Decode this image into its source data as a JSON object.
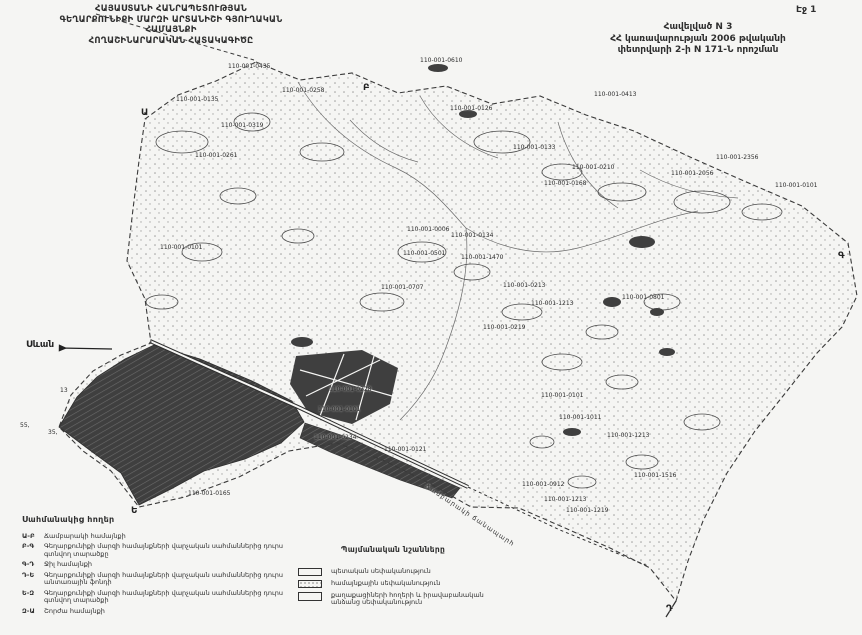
{
  "page": {
    "number_label": "Էջ 1"
  },
  "header": {
    "title_lines": [
      "ՀԱՅԱՍՏԱՆԻ ՀԱՆՐԱՊԵՏՈՒԹՅԱՆ",
      "ԳԵՂԱՐՔՈՒՆԻՔԻ ՄԱՐԶԻ ԱՐՏԱՆԻՇԻ ԳՅՈՒՂԱԿԱՆ ՀԱՄԱՅՆՔԻ",
      "ՀՈՂԱՇԻՆԱՐԱՐԱԿԱՆ ՀԱՏԱԿԱԳԻԾԸ"
    ],
    "decree_lines": [
      "Հավելված N 3",
      "ՀՀ կառավարության 2006 թվականի",
      "փետրվարի 2-ի N 171-Ն որոշման"
    ]
  },
  "map": {
    "lake_label": "Սևան",
    "road_label": "Ճամբարակի ճանապարհ",
    "boundary_letters": [
      {
        "ch": "Ա",
        "x": 141,
        "y": 109
      },
      {
        "ch": "Բ",
        "x": 363,
        "y": 84
      },
      {
        "ch": "Գ",
        "x": 838,
        "y": 252
      },
      {
        "ch": "Դ",
        "x": 666,
        "y": 605
      },
      {
        "ch": "Ե",
        "x": 131,
        "y": 507
      }
    ],
    "parcel_labels": [
      {
        "t": "110-001-0435",
        "x": 228,
        "y": 64
      },
      {
        "t": "110-001-0610",
        "x": 420,
        "y": 58
      },
      {
        "t": "110-001-0126",
        "x": 450,
        "y": 106
      },
      {
        "t": "110-001-0258",
        "x": 282,
        "y": 88
      },
      {
        "t": "110-001-0135",
        "x": 176,
        "y": 97
      },
      {
        "t": "110-001-0319",
        "x": 221,
        "y": 123
      },
      {
        "t": "110-001-0261",
        "x": 195,
        "y": 153
      },
      {
        "t": "110-001-0413",
        "x": 594,
        "y": 92
      },
      {
        "t": "110-001-0210",
        "x": 572,
        "y": 165
      },
      {
        "t": "110-001-2056",
        "x": 671,
        "y": 171
      },
      {
        "t": "110-001-2356",
        "x": 716,
        "y": 155
      },
      {
        "t": "110-001-0101",
        "x": 775,
        "y": 183
      },
      {
        "t": "110-001-0133",
        "x": 513,
        "y": 145
      },
      {
        "t": "110-001-0168",
        "x": 544,
        "y": 181
      },
      {
        "t": "110-001-0006",
        "x": 407,
        "y": 227
      },
      {
        "t": "110-001-0134",
        "x": 451,
        "y": 233
      },
      {
        "t": "110-001-0501",
        "x": 403,
        "y": 251
      },
      {
        "t": "110-001-1470",
        "x": 461,
        "y": 255
      },
      {
        "t": "110-001-0707",
        "x": 381,
        "y": 285
      },
      {
        "t": "110-001-0213",
        "x": 503,
        "y": 283
      },
      {
        "t": "110-001-1213",
        "x": 531,
        "y": 301
      },
      {
        "t": "110-001-0219",
        "x": 483,
        "y": 325
      },
      {
        "t": "110-001-0101",
        "x": 160,
        "y": 245
      },
      {
        "t": "110-001-0801",
        "x": 622,
        "y": 295
      },
      {
        "t": "110-001-0228",
        "x": 329,
        "y": 387
      },
      {
        "t": "110-001-0101",
        "x": 318,
        "y": 407
      },
      {
        "t": "110-001-0101",
        "x": 541,
        "y": 393
      },
      {
        "t": "110-001-1011",
        "x": 559,
        "y": 415
      },
      {
        "t": "110-001-1213",
        "x": 607,
        "y": 433
      },
      {
        "t": "110-001-1516",
        "x": 634,
        "y": 473
      },
      {
        "t": "110-001-0912",
        "x": 522,
        "y": 482
      },
      {
        "t": "110-001-1213",
        "x": 544,
        "y": 497
      },
      {
        "t": "110-001-1219",
        "x": 566,
        "y": 508
      },
      {
        "t": "110-001-0121",
        "x": 384,
        "y": 447
      },
      {
        "t": "110-001-0234",
        "x": 314,
        "y": 435
      },
      {
        "t": "110-001-0165",
        "x": 188,
        "y": 491
      },
      {
        "t": "13",
        "x": 60,
        "y": 388
      },
      {
        "t": "55,",
        "x": 20,
        "y": 423
      },
      {
        "t": "35,",
        "x": 48,
        "y": 430
      }
    ]
  },
  "legend_border": {
    "title": "Սահմանակից հողեր",
    "items": [
      {
        "code": "Ա-Բ",
        "label": "Ճամբարակի համայնքի"
      },
      {
        "code": "Բ-Գ",
        "label": "Գեղարքունիքի մարզի համայնքների վարչական սահմաններից դուրս գտնվող տարածքը"
      },
      {
        "code": "Գ-Դ",
        "label": "Ջիլ համայնքի"
      },
      {
        "code": "Դ-Ե",
        "label": "Գեղարքունիքի մարզի համայնքների վարչական սահմաններից դուրս անտառային ֆոնդի"
      },
      {
        "code": "Ե-Զ",
        "label": "Գեղարքունիքի մարզի համայնքների վարչական սահմաններից դուրս գտնվող տարածքի"
      },
      {
        "code": "Զ-Ա",
        "label": "Շորժա համայնքի"
      }
    ]
  },
  "legend_signs": {
    "title": "Պայմանական նշանները",
    "items": [
      {
        "swatch": "plain",
        "label": "պետական սեփականություն"
      },
      {
        "swatch": "dots",
        "label": "համայնքային սեփականություն"
      },
      {
        "swatch": "plain2",
        "label": "քաղաքացիների հողերի և իրավաբանական անձանց սեփականություն"
      }
    ]
  },
  "colors": {
    "ink": "#2e2e2e",
    "paper": "#f5f5f3",
    "dark_fill": "#3f3f3f"
  }
}
